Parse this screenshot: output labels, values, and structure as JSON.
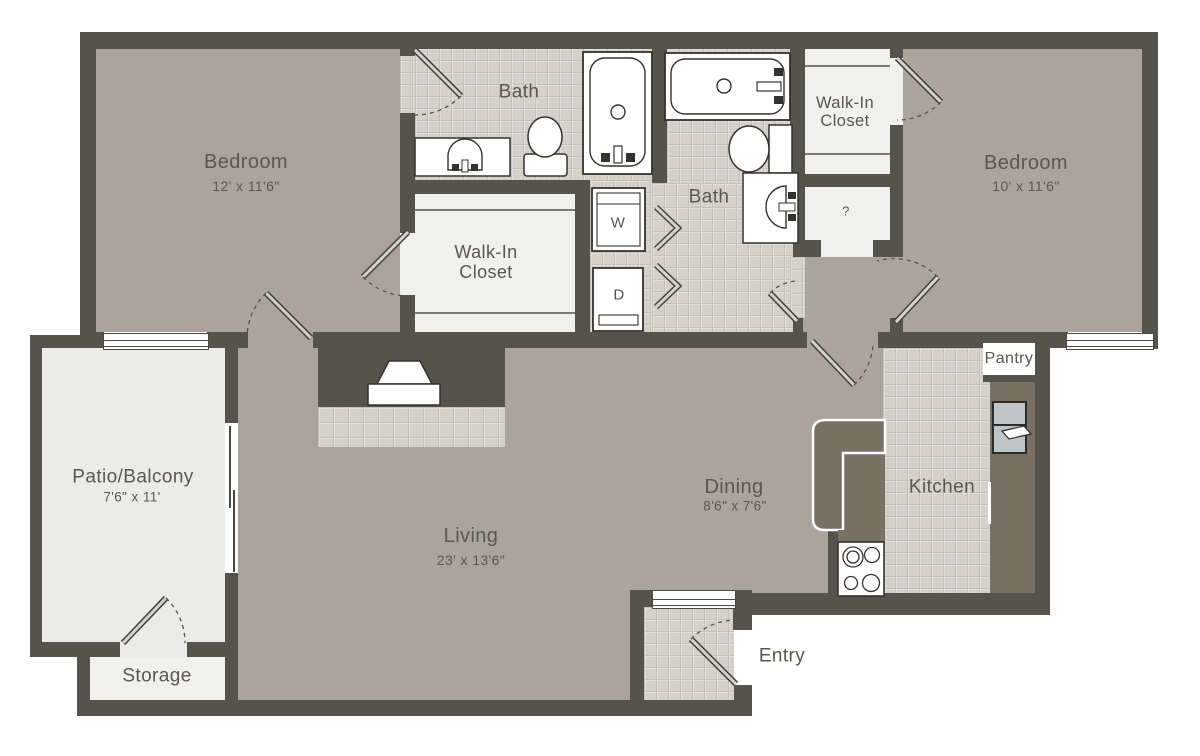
{
  "colors": {
    "wall": "#56534a",
    "floor": "#aca49b",
    "tile": "#d5d1c8",
    "tileline": "#c5c1b8",
    "light": "#f0f0ee",
    "patio": "#ebebe9",
    "counter": "#7a7063",
    "fridge": "#bec5c8",
    "text": "#5a574d",
    "white": "#ffffff"
  },
  "labels": {
    "bedroom1": {
      "name": "Bedroom",
      "dims": "12' x 11'6\""
    },
    "bedroom2": {
      "name": "Bedroom",
      "dims": "10' x 11'6\""
    },
    "bath1": {
      "name": "Bath"
    },
    "bath2": {
      "name": "Bath"
    },
    "walk_in_closet1": {
      "line1": "Walk-In",
      "line2": "Closet"
    },
    "walk_in_closet2": {
      "line1": "Walk-In",
      "line2": "Closet"
    },
    "living": {
      "name": "Living",
      "dims": "23' x 13'6\""
    },
    "dining": {
      "name": "Dining",
      "dims": "8'6\" x 7'6\""
    },
    "kitchen": {
      "name": "Kitchen"
    },
    "pantry": {
      "name": "Pantry"
    },
    "patio": {
      "name": "Patio/Balcony",
      "dims": "7'6\" x 11'"
    },
    "storage": {
      "name": "Storage"
    },
    "entry": {
      "name": "Entry"
    },
    "washer": "W",
    "dryer": "D",
    "utility": "?"
  }
}
